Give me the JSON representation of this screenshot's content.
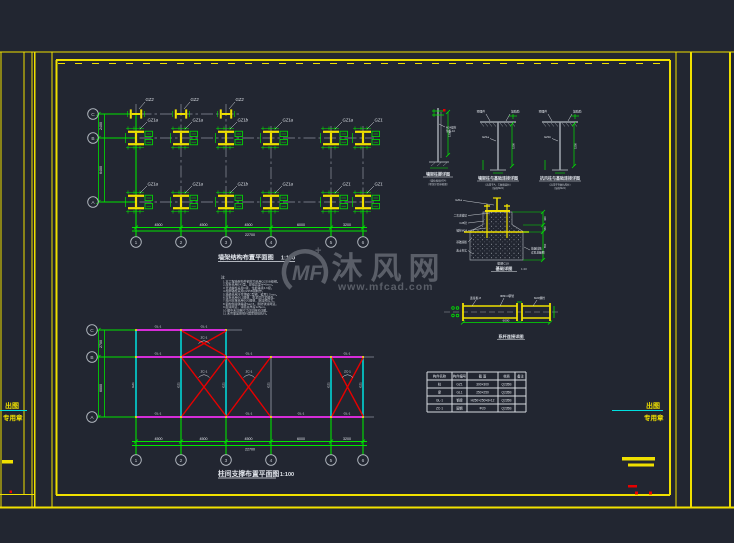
{
  "watermark": {
    "logo": "MF",
    "sparkle": "+",
    "name_chars": [
      "沐",
      "风",
      "网"
    ],
    "url": "www.mfcad.com"
  },
  "stamps": {
    "left1": "出图",
    "left2": "专用章",
    "right1": "出图",
    "right2": "专用章"
  },
  "plan1": {
    "title": "墙架结构布置平面图",
    "scale": "1:100",
    "notes_label": "注:",
    "notes": [
      "1.本工程墙架构件钢材均采用Q235B级钢。",
      "2.焊条采用E43型，焊缝高度hf=6mm。",
      "3.普通螺栓采用C级，性能等级4.6级。",
      "4.柱脚锚栓采用Q235B钢制作。",
      "5.墙梁采用冷弯薄壁C型钢，壁厚2.5mm。",
      "6.拉条采用Φ12圆钢，张紧后拧紧螺母。",
      "7.柱间支撑采用Φ20圆钢，施加预拉力。",
      "8.钢构件除锈等级Sa2.5，刷防锈漆两道。",
      "9.面漆两道，漆膜总厚度125μm。",
      "10.图中未注明尺寸详见相关详图。",
      "11.未尽事宜按现行国家规范执行。"
    ],
    "axis_cols": [
      "1",
      "2",
      "3",
      "4",
      "5",
      "6"
    ],
    "axis_rows": [
      "C",
      "B",
      "A"
    ],
    "labels_top": [
      "GZ2",
      "GZ2",
      "GZ2"
    ],
    "labels_mid": [
      "GZ1a",
      "GZ1a",
      "GZ1b",
      "GZ1a",
      "GZ1a",
      "GZ1"
    ],
    "labels_bot": [
      "GZ1a",
      "GZ1a",
      "GZ1b",
      "GZ1a",
      "GZ1",
      "GZ1"
    ],
    "dims_bottom": [
      "4500",
      "4500",
      "4500",
      "6000",
      "3200"
    ],
    "dim_total": "22700",
    "dims_left": [
      "2400",
      "6400"
    ]
  },
  "plan2": {
    "title": "柱间支撑布置平面图",
    "scale": "1:100",
    "axis_cols": [
      "1",
      "2",
      "3",
      "4",
      "5",
      "6"
    ],
    "axis_rows": [
      "C",
      "B",
      "A"
    ],
    "beam_label": "GL-1",
    "col_label": "GZ1",
    "brace_label": "ZC-1",
    "dims_bottom": [
      "4500",
      "4500",
      "4500",
      "6000",
      "3200"
    ],
    "dim_total": "22700",
    "dims_left": [
      "2700",
      "6000"
    ]
  },
  "details": {
    "d1": {
      "title": "墙架柱脚详图",
      "note1": "（锚栓规格M24）",
      "note2": "（埋深详见基础图）",
      "dim": "1200",
      "lead1": "M24锚栓",
      "lead2": "垫板-10"
    },
    "d2": {
      "title": "墙架柱与基础连接详图",
      "note1": "（适用于A、C轴墙架柱）",
      "note2": "（锚栓M24）",
      "dim": "1500",
      "lead1": "预埋件",
      "lead2": "加劲肋",
      "lead3": "GZ1a"
    },
    "d3": {
      "title": "抗风柱与基础连接详图",
      "note1": "（适用于B轴抗风柱）",
      "note2": "（锚栓M24）",
      "dim": "1500",
      "lead1": "预埋件",
      "lead2": "加劲肋",
      "lead3": "GZ1b"
    },
    "found": {
      "title": "基础详图",
      "scale": "1:20",
      "lead_top": "GZ1a",
      "leads_left": [
        "二次浇灌层",
        "C25砼",
        "锚栓M24",
        "基础底板",
        "素土夯实"
      ],
      "lead_right1": "基础插筋",
      "lead_right2": "详见基础图",
      "bottom_label": "垫层C10",
      "dims": [
        "300",
        "150",
        "550"
      ]
    },
    "beam": {
      "title": "系杆连接详图",
      "lead1": "连接板-8",
      "lead2": "Φ89×4钢管",
      "lead3": "M20螺栓",
      "dim": "6000"
    }
  },
  "table": {
    "headers": [
      "构件名称",
      "构件编号",
      "截  面",
      "材质",
      "备注"
    ],
    "rows": [
      [
        "柱",
        "GZ1",
        "300×300",
        "Q235B",
        ""
      ],
      [
        "梁",
        "GL1",
        "250×250",
        "Q235B",
        ""
      ],
      [
        "GL-1",
        "钢梁",
        "H250×250×8×12",
        "Q235B",
        ""
      ],
      [
        "ZC-1",
        "圆钢",
        "Φ20",
        "Q235B",
        ""
      ]
    ]
  }
}
